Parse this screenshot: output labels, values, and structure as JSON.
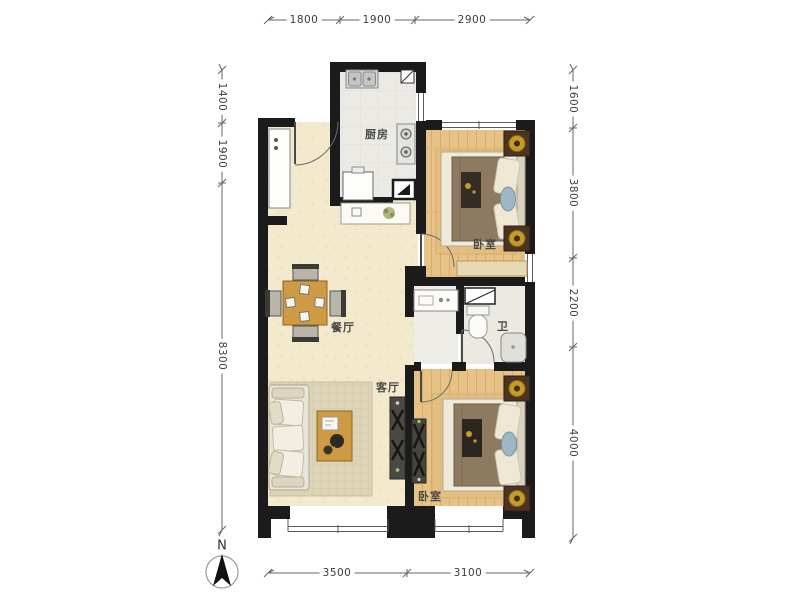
{
  "compass": {
    "label": "N"
  },
  "rooms": {
    "kitchen": "厨房",
    "bedroom_top": "卧室",
    "dining": "餐厅",
    "bath": "卫",
    "living": "客厅",
    "bedroom_bottom": "卧室"
  },
  "dimensions": {
    "top": [
      "1800",
      "1900",
      "2900"
    ],
    "left": [
      "1400",
      "1900",
      "8300"
    ],
    "right": [
      "1600",
      "3800",
      "2200",
      "4000"
    ],
    "bottom": [
      "3500",
      "3100"
    ]
  },
  "colors": {
    "wall": "#1b1b1b",
    "floor_main": "#f3e9cd",
    "floor_wood": "#e7c286",
    "floor_tile": "#eceae4",
    "furniture_wood": "#cf9a44",
    "bed_blanket": "#8d7a61",
    "lamp_gold": "#c79b29",
    "dimension_line": "#666666"
  }
}
